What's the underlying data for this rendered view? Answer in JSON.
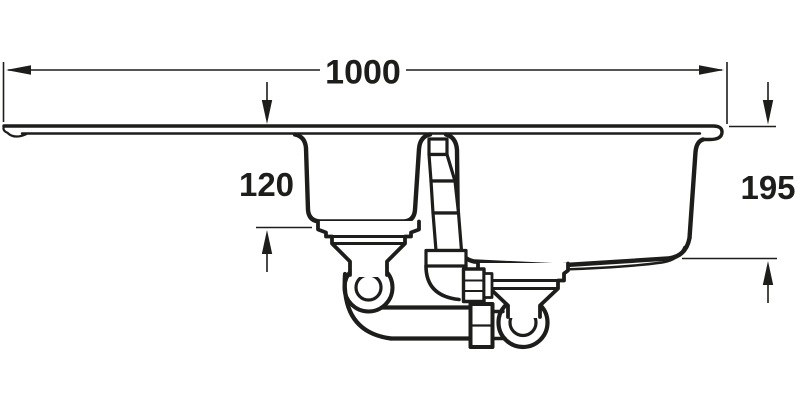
{
  "drawing": {
    "type": "technical-line-drawing",
    "subject": "one-and-a-half bowl inset sink with drainer and waste plumbing kit, side elevation",
    "background_color": "#ffffff",
    "line_color": "#1d1d1b",
    "dimensions": {
      "overall_width": {
        "label": "1000"
      },
      "half_bowl_depth": {
        "label": "120"
      },
      "main_bowl_depth": {
        "label": "195"
      }
    }
  }
}
